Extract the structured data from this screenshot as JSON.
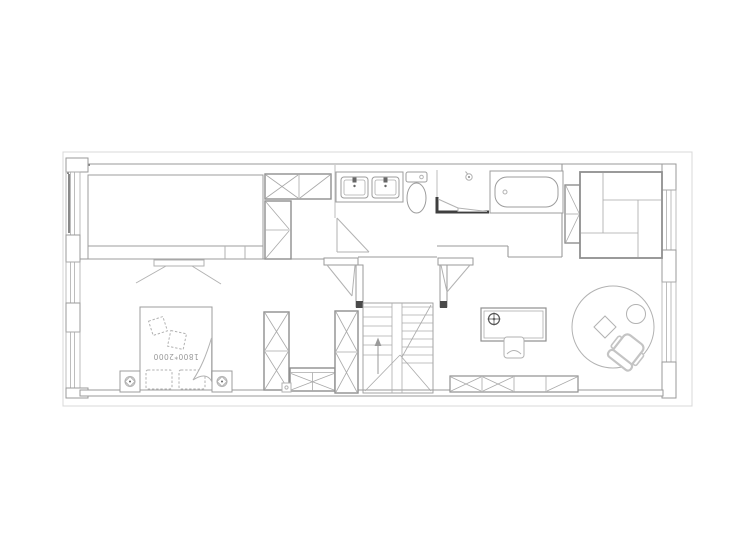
{
  "drawing": {
    "type": "architectural-floor-plan",
    "bed_label": "1800*2000",
    "stair_direction": "up"
  },
  "palette": {
    "background": "#ffffff",
    "boundary": "#d8d8d8",
    "wall": "#9a9a9a",
    "wall_accent": "#7d7d7d",
    "furniture": "#b2b2b2",
    "cabinet": "#8f8f8f",
    "dark_wall": "#3f3f3f",
    "label_text": "#9a9a9a"
  },
  "icons": {
    "nightstand_decor": "flower-icon",
    "desk_lamp": "target-icon",
    "shower": "shower-head-icon",
    "stair": "up-arrow-icon"
  },
  "furniture_items": [
    "walk-in-closet-platform",
    "closet-cabinets",
    "double-sink-vanity",
    "toilet",
    "shower",
    "bathtub",
    "sectional-daybed",
    "tv",
    "double-bed",
    "nightstands",
    "wardrobes",
    "u-shaped-stairs",
    "desk",
    "desk-chair",
    "round-rug",
    "office-chair",
    "stool",
    "low-cabinet"
  ]
}
